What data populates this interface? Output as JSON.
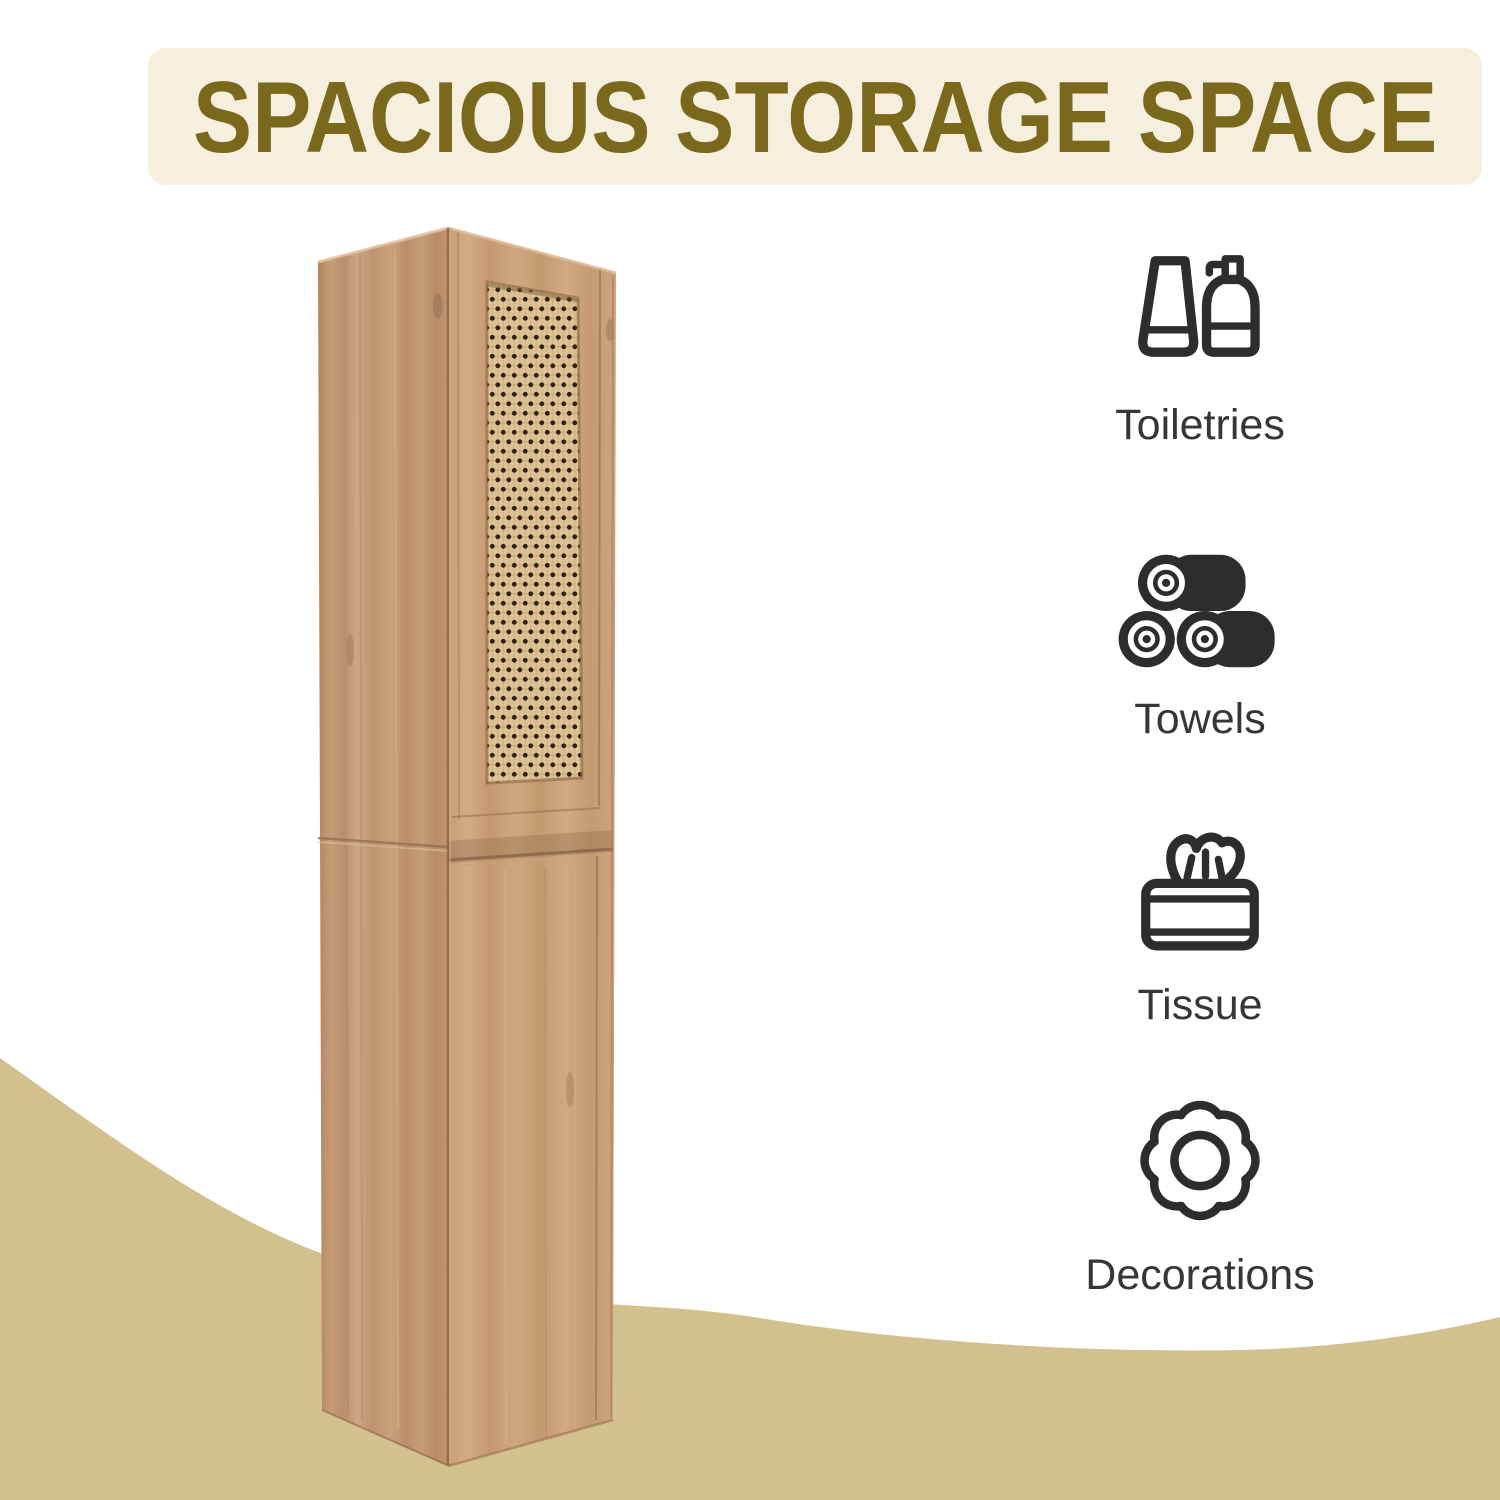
{
  "banner": {
    "title": "SPACIOUS STORAGE SPACE"
  },
  "features": [
    {
      "label": "Toiletries",
      "icon": "toiletries-icon"
    },
    {
      "label": "Towels",
      "icon": "towels-icon"
    },
    {
      "label": "Tissue",
      "icon": "tissue-icon"
    },
    {
      "label": "Decorations",
      "icon": "decorations-icon"
    }
  ],
  "product_photo": {
    "alt": "Tall natural oak bathroom storage cabinet shown at an angle, upper door with woven rattan cane panel, plain lower door"
  },
  "colors": {
    "banner_bg": "#f6efdd",
    "banner_text": "#7a691d",
    "wave": "#d2c08f",
    "label_text": "#363636",
    "icon_color": "#2d2d2d",
    "wood_light": "#cfa781",
    "wood_dark": "#b98c69",
    "rattan_bg": "#dcc296",
    "rattan_dot": "#2f2013"
  }
}
